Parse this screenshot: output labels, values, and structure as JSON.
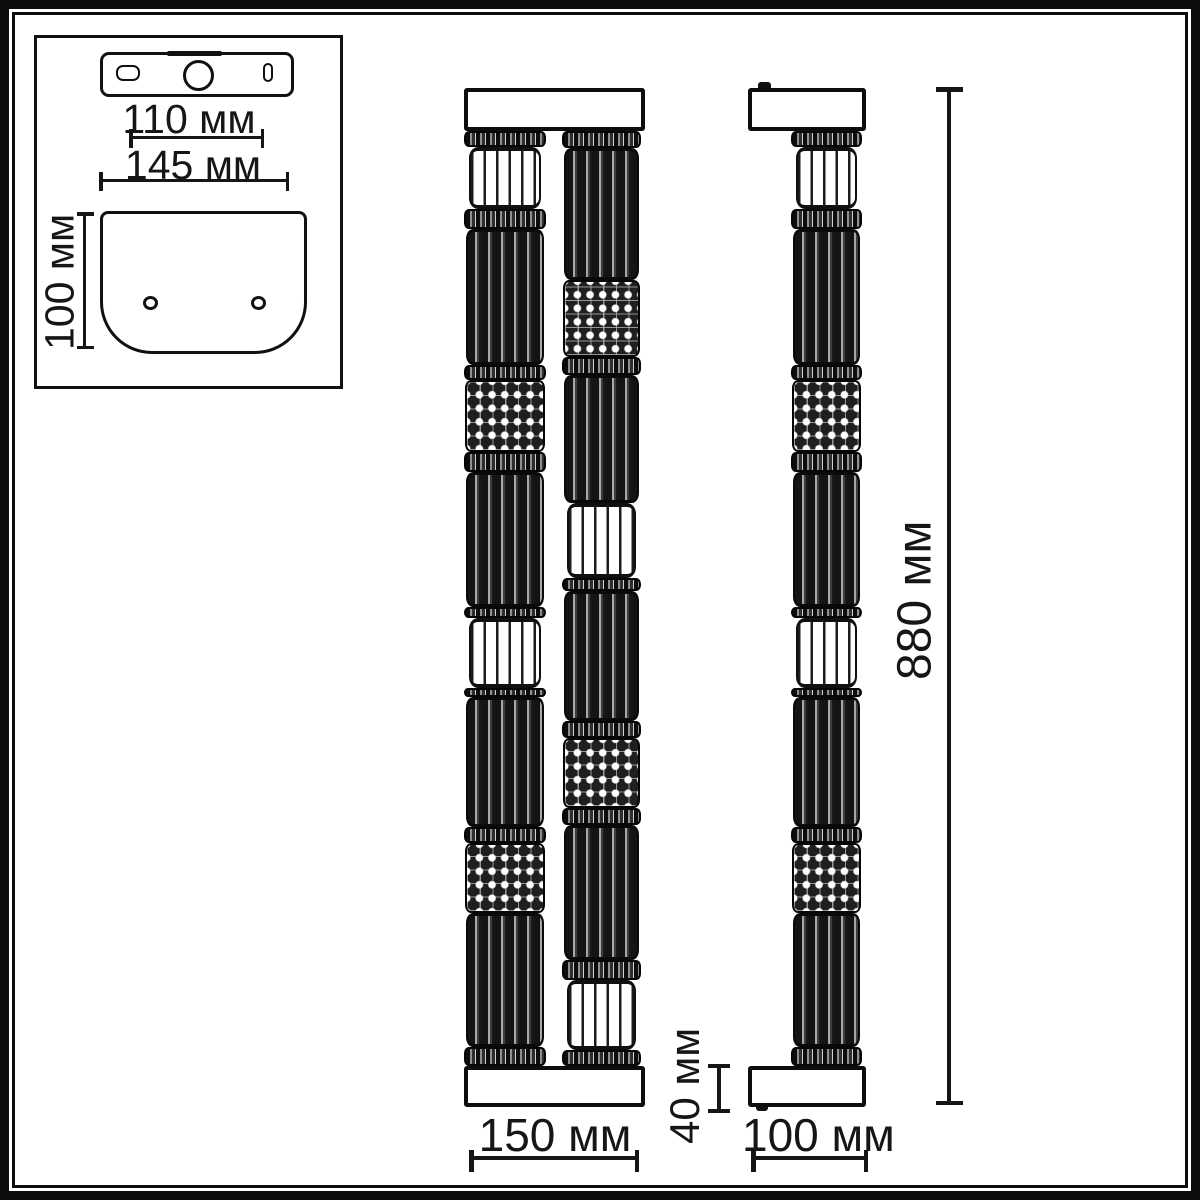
{
  "title": "wall-lamp dimension drawing",
  "units": "мм",
  "colors": {
    "line": "#161616",
    "background": "#ffffff",
    "fill_dark": "#1f1f1f",
    "fill_light": "#ffffff"
  },
  "inset": {
    "bracket_width_inner_label": "110 мм",
    "bracket_width_outer_label": "145 мм",
    "plate_height_label": "100 мм"
  },
  "front_view": {
    "width_label": "150 мм",
    "left_column_segments": [
      {
        "type": "ring",
        "h": 16
      },
      {
        "type": "white",
        "h": 62
      },
      {
        "type": "ring",
        "h": 20
      },
      {
        "type": "dark",
        "h": 136
      },
      {
        "type": "ring",
        "h": 15
      },
      {
        "type": "dots",
        "h": 72
      },
      {
        "type": "ring",
        "h": 20
      },
      {
        "type": "dark",
        "h": 135
      },
      {
        "type": "ring",
        "h": 11
      },
      {
        "type": "white",
        "h": 70
      },
      {
        "type": "ring",
        "h": 9
      },
      {
        "type": "dark",
        "h": 130
      },
      {
        "type": "ring",
        "h": 16
      },
      {
        "type": "dots",
        "h": 70
      },
      {
        "type": "dark",
        "h": 134
      },
      {
        "type": "ring",
        "h": 19
      }
    ],
    "right_column_segments": [
      {
        "type": "ring",
        "h": 17
      },
      {
        "type": "dark",
        "h": 132
      },
      {
        "type": "dots",
        "h": 77
      },
      {
        "type": "ring",
        "h": 18
      },
      {
        "type": "dark",
        "h": 128
      },
      {
        "type": "white",
        "h": 75
      },
      {
        "type": "ring",
        "h": 13
      },
      {
        "type": "dark",
        "h": 130
      },
      {
        "type": "ring",
        "h": 17
      },
      {
        "type": "dots",
        "h": 70
      },
      {
        "type": "ring",
        "h": 17
      },
      {
        "type": "dark",
        "h": 135
      },
      {
        "type": "ring",
        "h": 20
      },
      {
        "type": "white",
        "h": 70
      },
      {
        "type": "ring",
        "h": 16
      }
    ]
  },
  "side_view": {
    "height_label": "880 мм",
    "base_height_label": "40 мм",
    "base_width_label": "100 мм",
    "column_segments": [
      {
        "type": "ring",
        "h": 16
      },
      {
        "type": "white",
        "h": 62
      },
      {
        "type": "ring",
        "h": 20
      },
      {
        "type": "dark",
        "h": 136
      },
      {
        "type": "ring",
        "h": 15
      },
      {
        "type": "dots",
        "h": 72
      },
      {
        "type": "ring",
        "h": 20
      },
      {
        "type": "dark",
        "h": 135
      },
      {
        "type": "ring",
        "h": 11
      },
      {
        "type": "white",
        "h": 70
      },
      {
        "type": "ring",
        "h": 9
      },
      {
        "type": "dark",
        "h": 130
      },
      {
        "type": "ring",
        "h": 16
      },
      {
        "type": "dots",
        "h": 70
      },
      {
        "type": "dark",
        "h": 134
      },
      {
        "type": "ring",
        "h": 19
      }
    ]
  }
}
